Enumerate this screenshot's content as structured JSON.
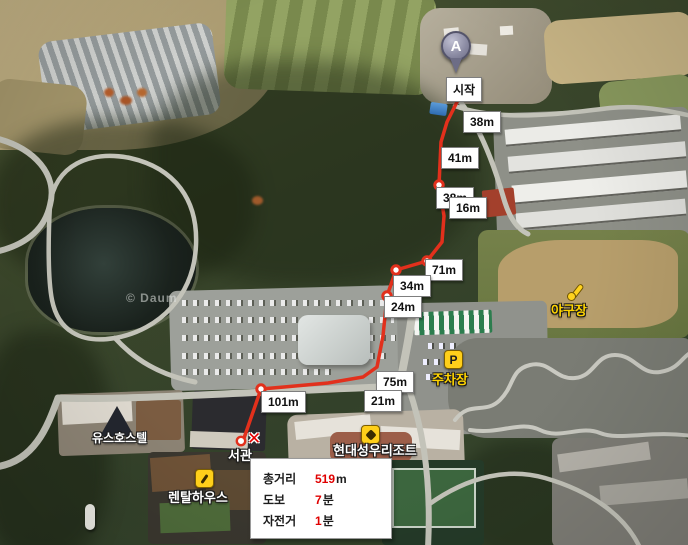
{
  "map": {
    "watermark": "© Daum",
    "start_label": "시작",
    "origin_marker_label": "A",
    "destination_marker_glyph": "✕"
  },
  "route": {
    "segment_labels": [
      "38m",
      "41m",
      "38m",
      "16m",
      "71m",
      "34m",
      "24m",
      "75m",
      "21m",
      "101m"
    ]
  },
  "pois": {
    "baseball_field": "야구장",
    "parking_lot": "주차장",
    "parking_icon_letter": "P",
    "youth_hostel": "유스호스텔",
    "rental_house": "렌탈하우스",
    "west_building": "서관",
    "resort": "현대성우리조트"
  },
  "summary": {
    "rows": [
      {
        "label": "총거리",
        "value": "519",
        "unit": "m"
      },
      {
        "label": "도보",
        "value": "7",
        "unit": "분"
      },
      {
        "label": "자전거",
        "value": "1",
        "unit": "분"
      }
    ]
  },
  "colors": {
    "route_red": "#e2301c",
    "summary_value_red": "#e00000",
    "poi_yellow": "#ffd400"
  }
}
